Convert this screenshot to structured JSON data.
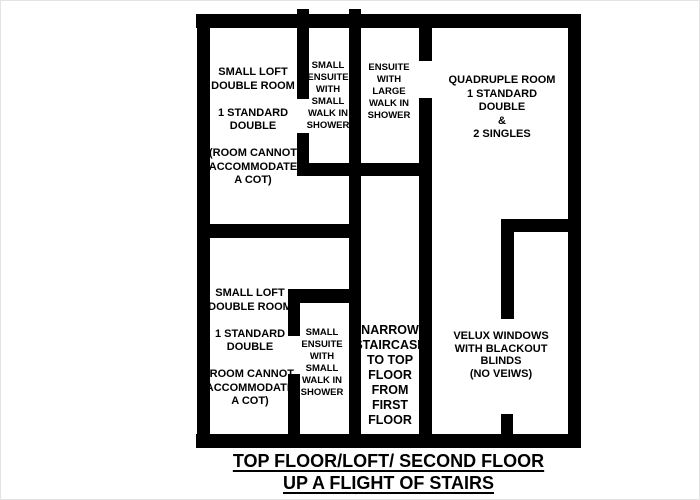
{
  "colors": {
    "wall": "#000000",
    "background": "#ffffff",
    "text": "#000000"
  },
  "rooms": {
    "top_left": {
      "label": "SMALL LOFT\nDOUBLE ROOM\n\n1 STANDARD\nDOUBLE\n\n(ROOM CANNOT\nACCOMMODATE\nA COT)"
    },
    "top_ensuite_small": {
      "label": "SMALL\nENSUITE\nWITH\nSMALL\nWALK IN\nSHOWER"
    },
    "ensuite_large": {
      "label": "ENSUITE\nWITH\nLARGE\nWALK IN\nSHOWER"
    },
    "quadruple": {
      "label": "QUADRUPLE ROOM\n1 STANDARD\nDOUBLE\n&\n2 SINGLES"
    },
    "bottom_left": {
      "label": "SMALL LOFT\nDOUBLE ROOM\n\n1 STANDARD\nDOUBLE\n\n(ROOM CANNOT\nACCOMMODATE\nA COT)"
    },
    "bottom_ensuite_small": {
      "label": "SMALL\nENSUITE\nWITH\nSMALL\nWALK IN\nSHOWER"
    },
    "staircase": {
      "label": "NARROW\nSTAIRCASE\nTO TOP\nFLOOR\nFROM\nFIRST\nFLOOR"
    },
    "velux": {
      "label": "VELUX WINDOWS\nWITH BLACKOUT\nBLINDS\n(NO VEIWS)"
    }
  },
  "caption": {
    "line1": "TOP FLOOR/LOFT/ SECOND FLOOR",
    "line2": "UP A FLIGHT OF STAIRS"
  }
}
